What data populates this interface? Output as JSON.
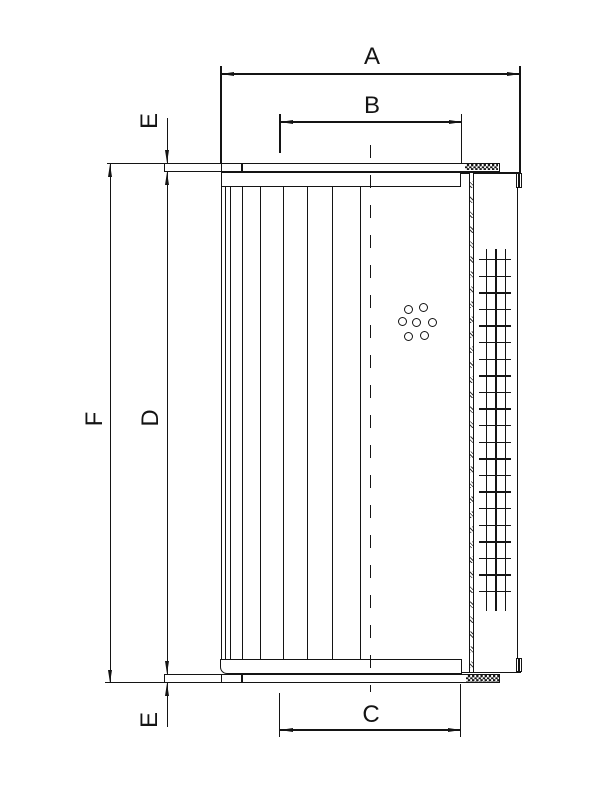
{
  "drawing": {
    "dim_labels": {
      "a": "A",
      "b": "B",
      "c": "C",
      "d": "D",
      "f": "F",
      "e_top": "E",
      "e_bottom": "E"
    }
  }
}
